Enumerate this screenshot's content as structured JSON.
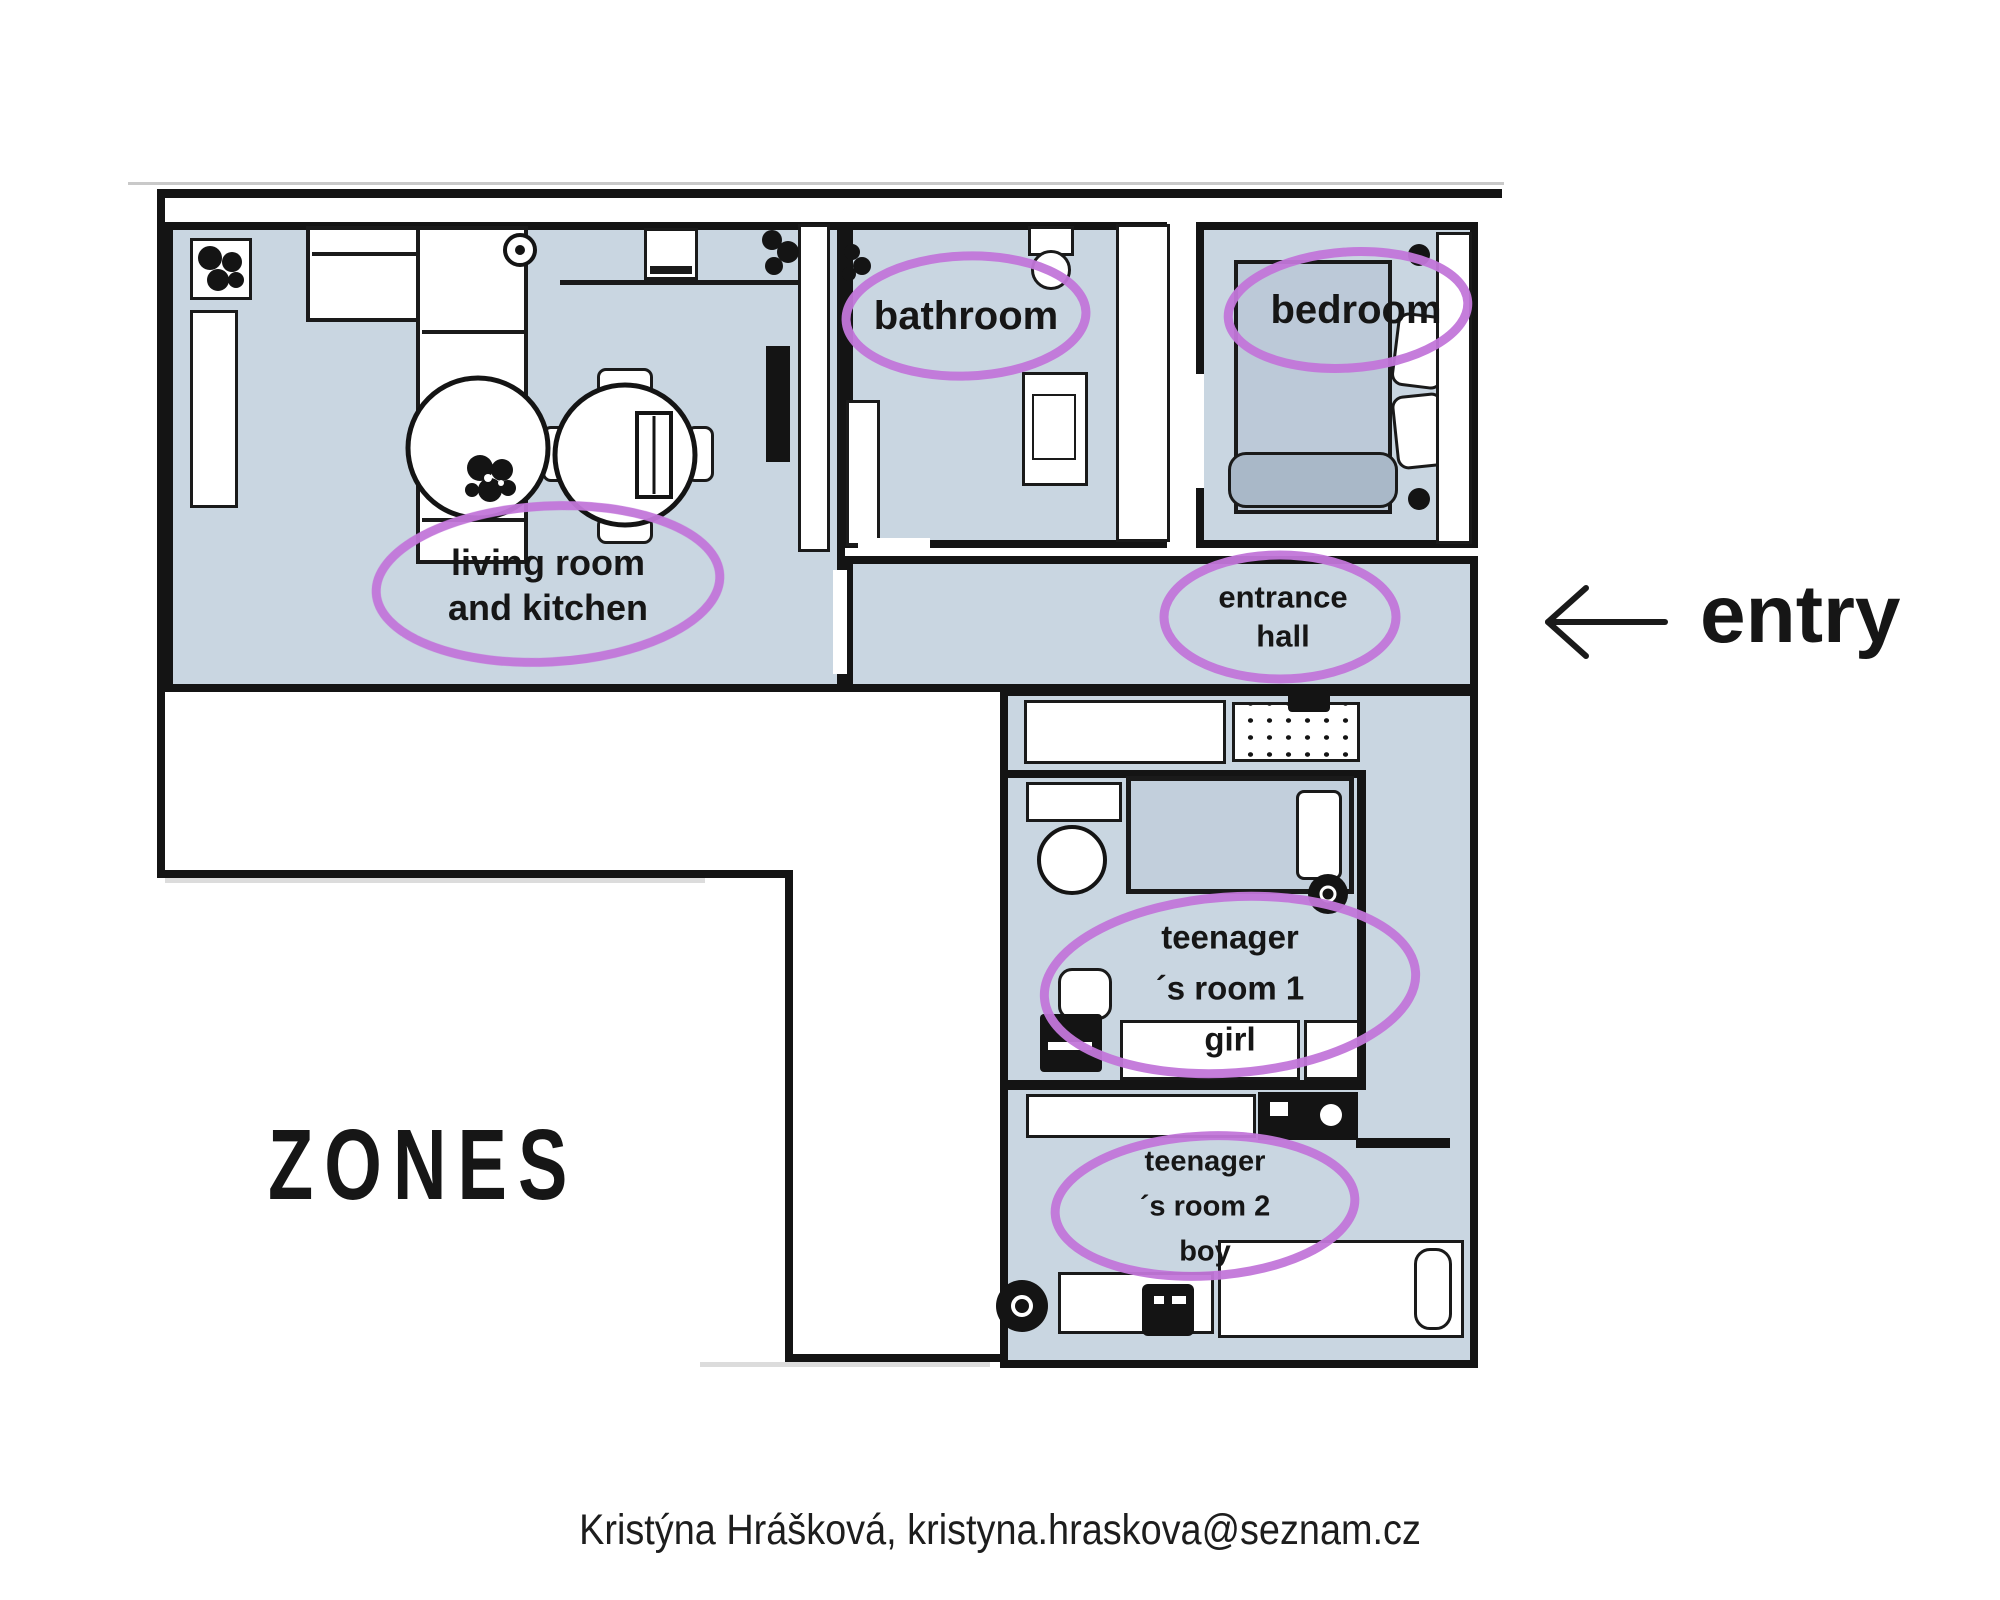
{
  "title": "apartment zones floor plan",
  "colors": {
    "room_fill": "#c9d6e1",
    "wall": "#141414",
    "zone_ellipse": "#c276da",
    "text": "#161616",
    "bed_fill": "#bcc9d8",
    "bed_roll": "#a9b8c8"
  },
  "rooms": {
    "living": {
      "label_line1": "living room",
      "label_line2": "and kitchen"
    },
    "bathroom": {
      "label": "bathroom"
    },
    "bedroom": {
      "label": "bedroom"
    },
    "entrance": {
      "label_line1": "entrance",
      "label_line2": "hall"
    },
    "teen1": {
      "label_line1": "teenager",
      "label_line2": "´s room 1",
      "label_line3": "girl"
    },
    "teen2": {
      "label_line1": "teenager",
      "label_line2": "´s room 2",
      "label_line3": "boy"
    }
  },
  "annotations": {
    "entry": "entry",
    "zones": "ZONES"
  },
  "footer": {
    "credit": "Kristýna Hrášková, kristyna.hraskova@seznam.cz"
  }
}
